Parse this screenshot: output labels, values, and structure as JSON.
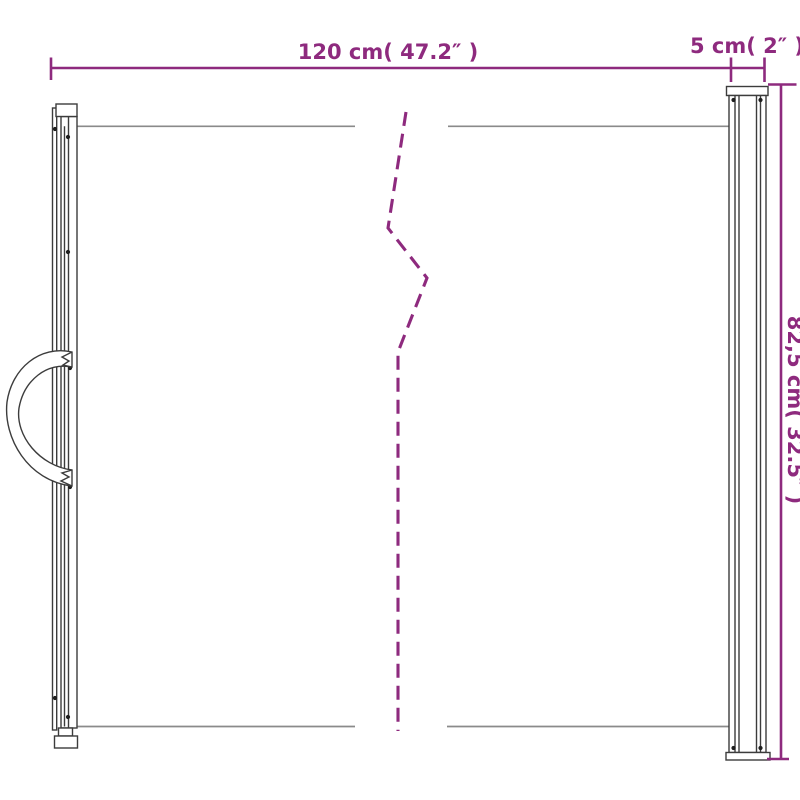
{
  "diagram": {
    "labels": {
      "width": "120 cm( 47.2″ )",
      "depth": "5 cm( 2″ )",
      "height": "82,5 cm( 32.5″ )"
    },
    "measurements": {
      "width": {
        "cm": 120,
        "inches": 47.2
      },
      "depth": {
        "cm": 5,
        "inches": 2
      },
      "height": {
        "cm": 82.5,
        "inches": 32.5
      }
    },
    "colors": {
      "accent": "#8e2a7e",
      "outline": "#3c3c3c",
      "panel_edge": "#8a8a8a",
      "background": "#ffffff"
    },
    "parts": [
      "handle-post-with-strap",
      "retractable-panel",
      "break-line",
      "cassette-post"
    ]
  }
}
